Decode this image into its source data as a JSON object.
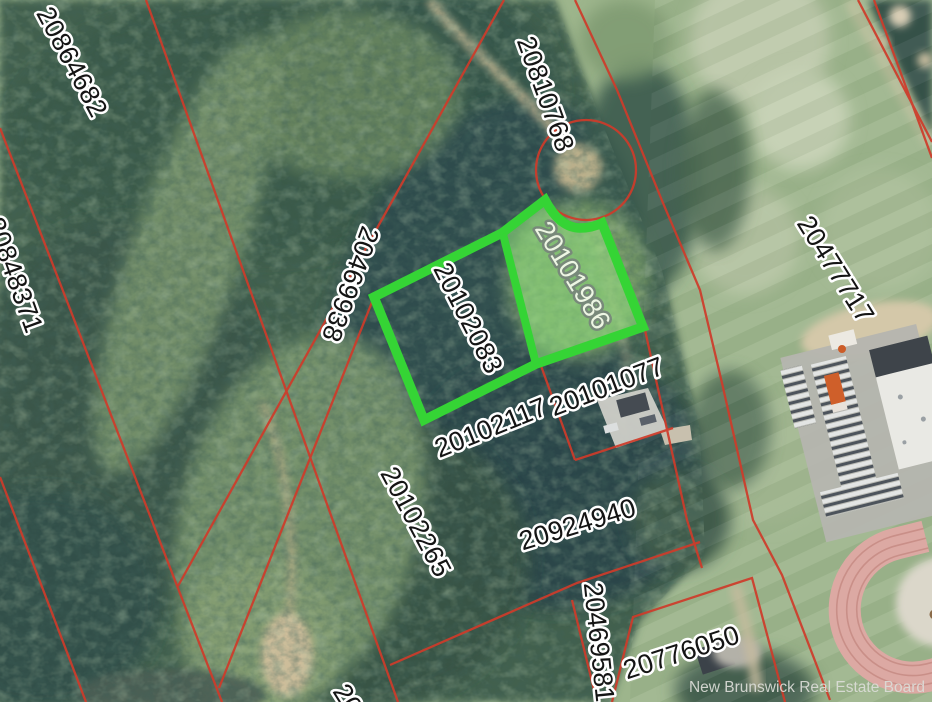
{
  "map": {
    "watermark": "New Brunswick Real Estate Board",
    "selected_parcel": "20101986",
    "outlined_parcel": "20102083",
    "colors": {
      "parcel_line_red": "#cf3b2a",
      "highlight_stroke_green": "#35d435",
      "highlight_fill_green": "#90e07c",
      "label_text": "#141414",
      "label_halo": "#ffffff",
      "selected_label_text": "#edf6e3",
      "selected_label_halo": "#78897a"
    },
    "parcel_labels": [
      {
        "pid": "20864682"
      },
      {
        "pid": "20848371"
      },
      {
        "pid": "20810768"
      },
      {
        "pid": "20469938"
      },
      {
        "pid": "20477717"
      },
      {
        "pid": "20102083"
      },
      {
        "pid": "20101986"
      },
      {
        "pid": "20102117"
      },
      {
        "pid": "20101077"
      },
      {
        "pid": "20102265"
      },
      {
        "pid": "20924940"
      },
      {
        "pid": "20469581"
      },
      {
        "pid": "20776050"
      },
      {
        "pid": "20"
      }
    ]
  }
}
